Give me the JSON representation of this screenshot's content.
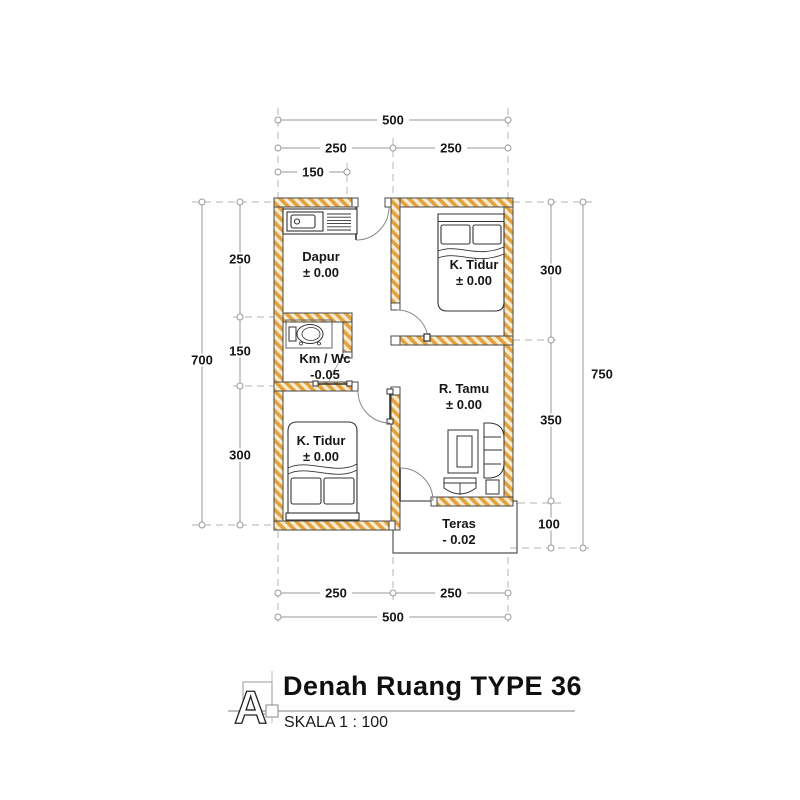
{
  "drawing": {
    "rooms": {
      "dapur": {
        "name": "Dapur",
        "level": "± 0.00"
      },
      "ktidur_atas": {
        "name": "K. Tidur",
        "level": "± 0.00"
      },
      "kmwc": {
        "name": "Km / Wc",
        "level": "-0.05"
      },
      "rtamu": {
        "name": "R. Tamu",
        "level": "± 0.00"
      },
      "ktidur_bawah": {
        "name": "K. Tidur",
        "level": "± 0.00"
      },
      "teras": {
        "name": "Teras",
        "level": "- 0.02"
      }
    },
    "dimensions": {
      "top_total": "500",
      "top_left": "250",
      "top_right": "250",
      "top_kitchen": "150",
      "left_dapur": "250",
      "left_kmwc": "150",
      "left_ktidur": "300",
      "left_total": "700",
      "right_ktidur": "300",
      "right_rtamu": "350",
      "right_teras": "100",
      "right_total": "750",
      "bottom_left": "250",
      "bottom_right": "250",
      "bottom_total": "500"
    },
    "colors": {
      "wall_hatch_orange": "#E3A140",
      "wall_hatch_light": "#F8ECCF",
      "outline": "#4a4a4a",
      "dimension_line": "#999999",
      "dashed_grid": "#c2c2c2"
    }
  },
  "title_block": {
    "marker": "A",
    "title": "Denah Ruang TYPE 36",
    "scale": "SKALA 1 : 100"
  }
}
